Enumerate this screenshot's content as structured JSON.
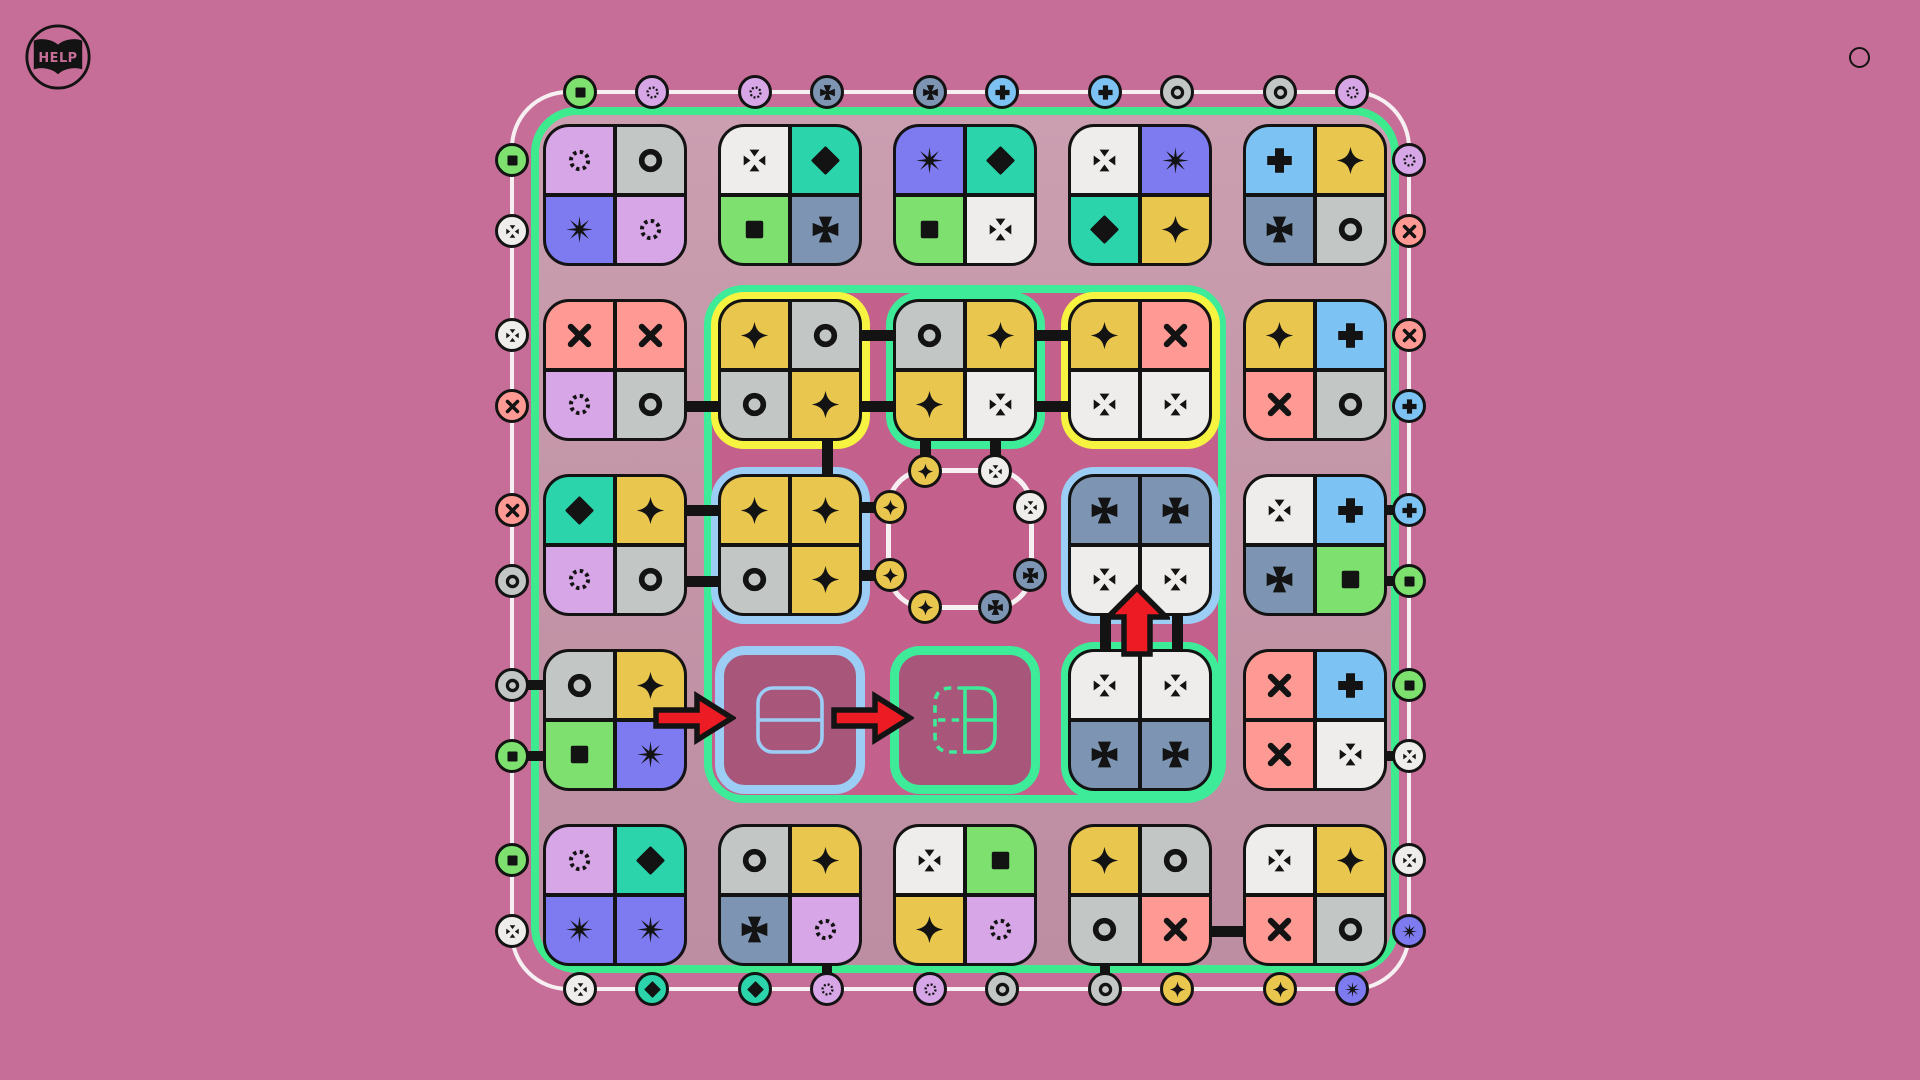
{
  "app": {
    "help_label": "HELP"
  },
  "colors": {
    "page_bg": "#c76e98",
    "board_zone_bg": "#c294a6",
    "inner_zone_bg": "#c4608c",
    "slot_bg": "#a9567b",
    "frame_white": "#f6f0f3",
    "edge_green": "#3deb8e",
    "line_black": "#131313",
    "arrow_red": "#ed1c24"
  },
  "symbol_colors": {
    "square": "#7de06f",
    "ring": "#c2c7c6",
    "dotted-circle": "#d7a6e6",
    "x": "#fe9a93",
    "star4": "#e9c74e",
    "diamond": "#2bd4ab",
    "burst": "#7e7bf0",
    "plus": "#7cc3f3",
    "pattee": "#7d95b2",
    "dotted-x": "#eeedeb"
  },
  "highlight_colors": {
    "yellow": "#f6f440",
    "green": "#3deb98",
    "blue": "#9ccdf4"
  },
  "board": {
    "grid": {
      "rows": 5,
      "cols": 5
    },
    "tiles": [
      {
        "r": 0,
        "c": 0,
        "type": "tile",
        "cells": [
          "dotted-circle",
          "ring",
          "burst",
          "dotted-circle"
        ]
      },
      {
        "r": 0,
        "c": 1,
        "type": "tile",
        "cells": [
          "dotted-x",
          "diamond",
          "square",
          "pattee"
        ]
      },
      {
        "r": 0,
        "c": 2,
        "type": "tile",
        "cells": [
          "burst",
          "diamond",
          "square",
          "dotted-x"
        ]
      },
      {
        "r": 0,
        "c": 3,
        "type": "tile",
        "cells": [
          "dotted-x",
          "burst",
          "diamond",
          "star4"
        ]
      },
      {
        "r": 0,
        "c": 4,
        "type": "tile",
        "cells": [
          "plus",
          "star4",
          "pattee",
          "ring"
        ]
      },
      {
        "r": 1,
        "c": 0,
        "type": "tile",
        "cells": [
          "x",
          "x",
          "dotted-circle",
          "ring"
        ]
      },
      {
        "r": 1,
        "c": 1,
        "type": "tile",
        "hl": "yellow",
        "cells": [
          "star4",
          "ring",
          "ring",
          "star4"
        ]
      },
      {
        "r": 1,
        "c": 2,
        "type": "tile",
        "hl": "green",
        "cells": [
          "ring",
          "star4",
          "star4",
          "dotted-x"
        ]
      },
      {
        "r": 1,
        "c": 3,
        "type": "tile",
        "hl": "yellow",
        "cells": [
          "star4",
          "x",
          "dotted-x",
          "dotted-x"
        ]
      },
      {
        "r": 1,
        "c": 4,
        "type": "tile",
        "cells": [
          "star4",
          "plus",
          "x",
          "ring"
        ]
      },
      {
        "r": 2,
        "c": 0,
        "type": "tile",
        "cells": [
          "diamond",
          "star4",
          "dotted-circle",
          "ring"
        ]
      },
      {
        "r": 2,
        "c": 1,
        "type": "tile",
        "hl": "blue",
        "cells": [
          "star4",
          "star4",
          "ring",
          "star4"
        ]
      },
      {
        "r": 2,
        "c": 2,
        "type": "ring-slot"
      },
      {
        "r": 2,
        "c": 3,
        "type": "tile",
        "hl": "blue",
        "cells": [
          "pattee",
          "pattee",
          "dotted-x",
          "dotted-x"
        ]
      },
      {
        "r": 2,
        "c": 4,
        "type": "tile",
        "cells": [
          "dotted-x",
          "plus",
          "pattee",
          "square"
        ]
      },
      {
        "r": 3,
        "c": 0,
        "type": "tile",
        "cells": [
          "ring",
          "star4",
          "square",
          "burst"
        ]
      },
      {
        "r": 3,
        "c": 1,
        "type": "slot",
        "hl": "blue",
        "ghost": "solid-split-h"
      },
      {
        "r": 3,
        "c": 2,
        "type": "slot",
        "hl": "green",
        "ghost": "dashed-left-split"
      },
      {
        "r": 3,
        "c": 3,
        "type": "tile",
        "hl": "green",
        "cells": [
          "dotted-x",
          "dotted-x",
          "pattee",
          "pattee"
        ]
      },
      {
        "r": 3,
        "c": 4,
        "type": "tile",
        "cells": [
          "x",
          "plus",
          "x",
          "dotted-x"
        ]
      },
      {
        "r": 4,
        "c": 0,
        "type": "tile",
        "cells": [
          "dotted-circle",
          "diamond",
          "burst",
          "burst"
        ]
      },
      {
        "r": 4,
        "c": 1,
        "type": "tile",
        "cells": [
          "ring",
          "star4",
          "pattee",
          "dotted-circle"
        ]
      },
      {
        "r": 4,
        "c": 2,
        "type": "tile",
        "cells": [
          "dotted-x",
          "square",
          "star4",
          "dotted-circle"
        ]
      },
      {
        "r": 4,
        "c": 3,
        "type": "tile",
        "cells": [
          "star4",
          "ring",
          "ring",
          "x"
        ]
      },
      {
        "r": 4,
        "c": 4,
        "type": "tile",
        "cells": [
          "dotted-x",
          "star4",
          "x",
          "ring"
        ]
      }
    ],
    "ring": {
      "tokens": [
        {
          "pos": "top-left",
          "sym": "star4"
        },
        {
          "pos": "top-right",
          "sym": "dotted-x"
        },
        {
          "pos": "right-upper",
          "sym": "dotted-x"
        },
        {
          "pos": "right-lower",
          "sym": "pattee"
        },
        {
          "pos": "bottom-right",
          "sym": "pattee"
        },
        {
          "pos": "bottom-left",
          "sym": "star4"
        },
        {
          "pos": "left-lower",
          "sym": "star4"
        },
        {
          "pos": "left-upper",
          "sym": "star4"
        }
      ]
    },
    "edge_tokens": {
      "top": [
        "square",
        "dotted-circle",
        "dotted-circle",
        "pattee",
        "pattee",
        "plus",
        "plus",
        "ring",
        "ring",
        "dotted-circle"
      ],
      "right": [
        "dotted-circle",
        "x",
        "x",
        "plus",
        "plus",
        "square",
        "square",
        "dotted-x",
        "dotted-x",
        "burst"
      ],
      "bottom": [
        "dotted-x",
        "diamond",
        "diamond",
        "dotted-circle",
        "dotted-circle",
        "ring",
        "ring",
        "star4",
        "star4",
        "burst"
      ],
      "left": [
        "square",
        "dotted-x",
        "dotted-x",
        "x",
        "x",
        "ring",
        "ring",
        "square",
        "square",
        "dotted-x"
      ]
    },
    "connectors": {
      "pairs": [
        {
          "a": [
            1,
            0,
            "BR"
          ],
          "b": [
            1,
            1,
            "BL"
          ]
        },
        {
          "a": [
            1,
            1,
            "TR"
          ],
          "b": [
            1,
            2,
            "TL"
          ]
        },
        {
          "a": [
            1,
            1,
            "BR"
          ],
          "b": [
            1,
            2,
            "BL"
          ]
        },
        {
          "a": [
            1,
            2,
            "TR"
          ],
          "b": [
            1,
            3,
            "TL"
          ]
        },
        {
          "a": [
            1,
            2,
            "BR"
          ],
          "b": [
            1,
            3,
            "BL"
          ]
        },
        {
          "a": [
            2,
            0,
            "TR"
          ],
          "b": [
            2,
            1,
            "TL"
          ]
        },
        {
          "a": [
            2,
            0,
            "BR"
          ],
          "b": [
            2,
            1,
            "BL"
          ]
        },
        {
          "a": [
            4,
            3,
            "BR"
          ],
          "b": [
            4,
            4,
            "BL"
          ]
        },
        {
          "a": [
            1,
            1,
            "BR"
          ],
          "b": [
            2,
            1,
            "TR"
          ]
        },
        {
          "a": [
            2,
            3,
            "BL"
          ],
          "b": [
            3,
            3,
            "TL"
          ]
        },
        {
          "a": [
            2,
            3,
            "BR"
          ],
          "b": [
            3,
            3,
            "TR"
          ]
        }
      ],
      "ring_links": [
        {
          "cell": [
            1,
            2,
            "BL"
          ],
          "token": 0
        },
        {
          "cell": [
            1,
            2,
            "BR"
          ],
          "token": 1
        },
        {
          "cell": [
            2,
            1,
            "TR"
          ],
          "token": 7
        },
        {
          "cell": [
            2,
            1,
            "BR"
          ],
          "token": 6
        }
      ],
      "edge_links": [
        {
          "side": "left",
          "index": 6,
          "cell": [
            3,
            0,
            "TL"
          ]
        },
        {
          "side": "left",
          "index": 7,
          "cell": [
            3,
            0,
            "BL"
          ]
        },
        {
          "side": "right",
          "index": 4,
          "cell": [
            2,
            4,
            "TR"
          ]
        },
        {
          "side": "right",
          "index": 5,
          "cell": [
            2,
            4,
            "BR"
          ]
        },
        {
          "side": "right",
          "index": 7,
          "cell": [
            3,
            4,
            "BR"
          ]
        },
        {
          "side": "bottom",
          "index": 3,
          "cell": [
            4,
            1,
            "BR"
          ]
        },
        {
          "side": "bottom",
          "index": 6,
          "cell": [
            4,
            3,
            "BL"
          ]
        }
      ]
    },
    "arrows": [
      {
        "dir": "right",
        "x": 652,
        "y": 691
      },
      {
        "dir": "right",
        "x": 830,
        "y": 691
      },
      {
        "dir": "up",
        "x": 1104,
        "y": 584
      }
    ]
  }
}
